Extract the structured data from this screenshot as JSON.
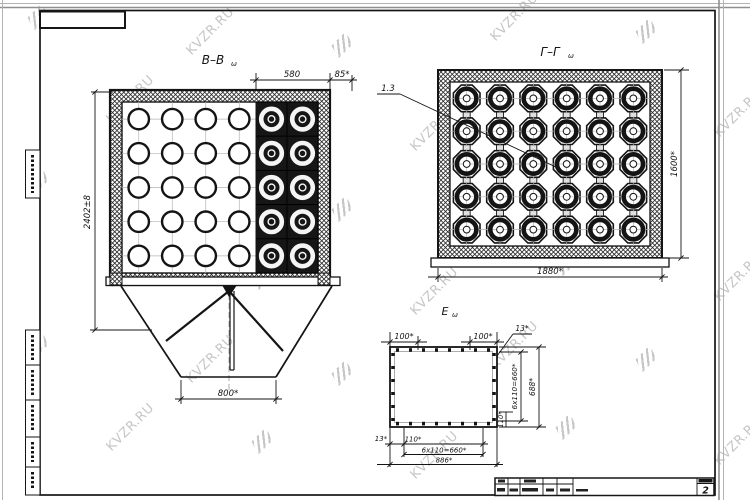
{
  "watermark": {
    "text": "KVZR.RU"
  },
  "sheet": {
    "number": "2"
  },
  "views": {
    "bb": {
      "label": "В–В",
      "label_sub": "ω",
      "dim_top_inner": "580",
      "dim_top_edge": "85*",
      "dim_height": "2402±8",
      "dim_outlet": "800*",
      "tube_grid": {
        "cols": 4,
        "rows": 5
      },
      "ring_grid": {
        "cols": 2,
        "rows": 5
      }
    },
    "gg": {
      "label": "Г–Г",
      "label_sub": "ω",
      "leader": "1.3",
      "dim_width": "1880*",
      "dim_height": "1600*",
      "grid": {
        "cols": 6,
        "rows": 5
      }
    },
    "e": {
      "label": "Е",
      "label_sub": "ω",
      "dim_left_offset": "100*",
      "dim_right_offset": "100*",
      "dim_corner_top": "13*",
      "dim_pitch_right": "6х110=660*",
      "dim_total_right": "688*",
      "dim_small_right": "110*",
      "dim_corner_bottom": "13*",
      "dim_small_bottom": "110*",
      "dim_pitch_bottom": "6х110=660*",
      "dim_total_bottom": "886*"
    }
  }
}
